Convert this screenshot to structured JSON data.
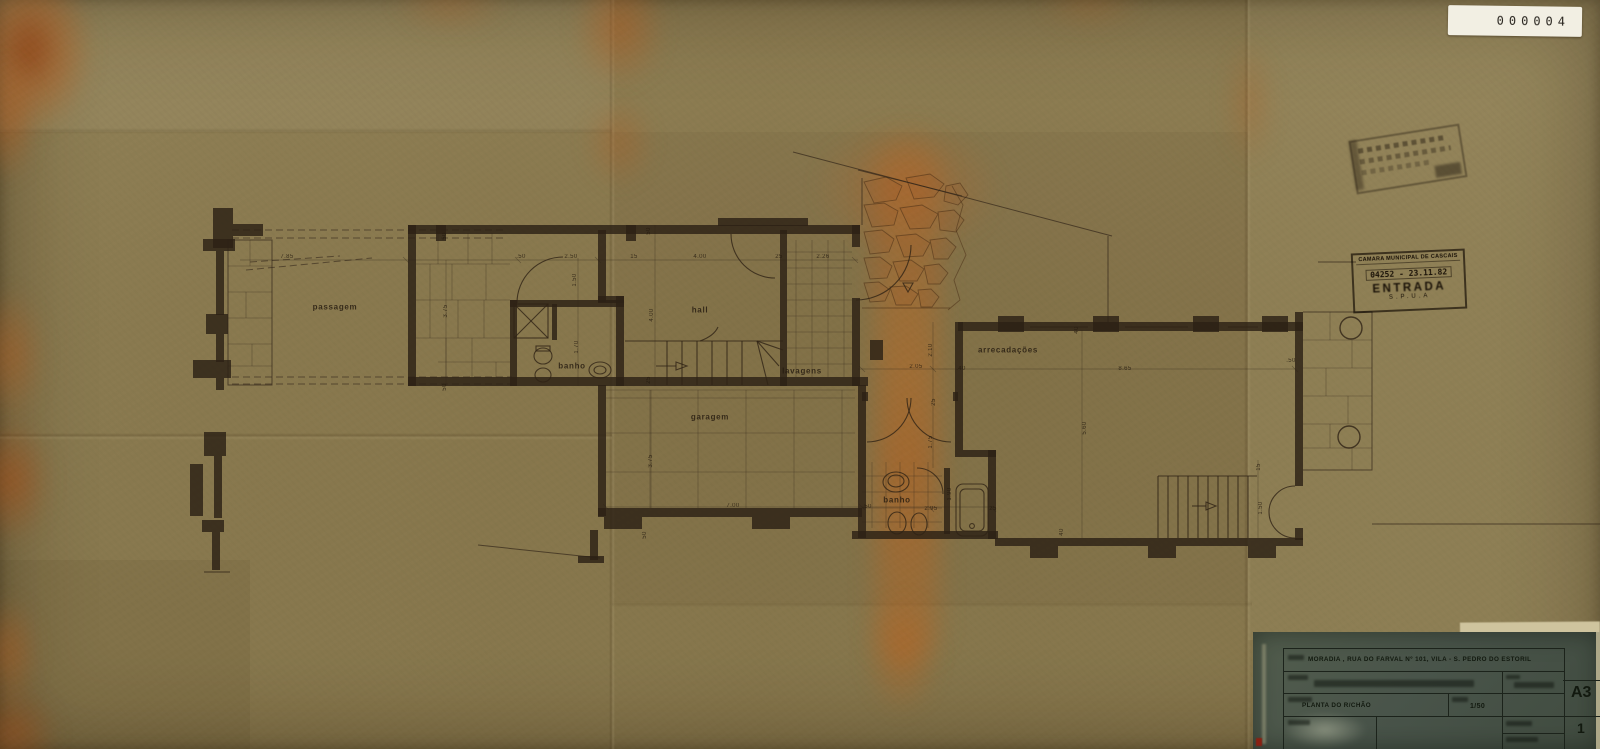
{
  "tag": {
    "number": "000004"
  },
  "entry_stamp": {
    "org_line": "CÂMARA MUNICIPAL DE CASCAIS",
    "number_date": "04252 - 23.11.82",
    "word": "ENTRADA",
    "dept": "S.P.U.A"
  },
  "plan": {
    "rooms": [
      {
        "label": "passagem",
        "x": 335,
        "y": 307
      },
      {
        "label": "banho",
        "x": 572,
        "y": 366
      },
      {
        "label": "hall",
        "x": 700,
        "y": 310
      },
      {
        "label": "lavagens",
        "x": 802,
        "y": 371
      },
      {
        "label": "garagem",
        "x": 710,
        "y": 417
      },
      {
        "label": "arrecadações",
        "x": 1008,
        "y": 350
      },
      {
        "label": "banho",
        "x": 897,
        "y": 500
      }
    ],
    "dimensions": [
      {
        "t": "7.85",
        "x": 287,
        "y": 257,
        "r": 0
      },
      {
        "t": ".50",
        "x": 521,
        "y": 257,
        "r": 0
      },
      {
        "t": "2.50",
        "x": 571,
        "y": 257,
        "r": 0
      },
      {
        "t": "15",
        "x": 634,
        "y": 257,
        "r": 0
      },
      {
        "t": "4.00",
        "x": 700,
        "y": 257,
        "r": 0
      },
      {
        "t": "25",
        "x": 779,
        "y": 257,
        "r": 0
      },
      {
        "t": "2.26",
        "x": 823,
        "y": 257,
        "r": 0
      },
      {
        "t": "50",
        "x": 445,
        "y": 236,
        "r": 90
      },
      {
        "t": "50",
        "x": 649,
        "y": 231,
        "r": 90
      },
      {
        "t": "50",
        "x": 445,
        "y": 387,
        "r": 90
      },
      {
        "t": "1.50",
        "x": 575,
        "y": 280,
        "r": 90
      },
      {
        "t": "1.70",
        "x": 577,
        "y": 347,
        "r": 90
      },
      {
        "t": "4.00",
        "x": 652,
        "y": 315,
        "r": 90
      },
      {
        "t": "25",
        "x": 649,
        "y": 380,
        "r": 90
      },
      {
        "t": "3.75",
        "x": 446,
        "y": 311,
        "r": 90
      },
      {
        "t": "2.05",
        "x": 916,
        "y": 367,
        "r": 0
      },
      {
        "t": "2.10",
        "x": 931,
        "y": 350,
        "r": 90
      },
      {
        "t": ".40",
        "x": 961,
        "y": 369,
        "r": 0
      },
      {
        "t": "25",
        "x": 934,
        "y": 402,
        "r": 90
      },
      {
        "t": "1.75",
        "x": 931,
        "y": 442,
        "r": 90
      },
      {
        "t": "40",
        "x": 1077,
        "y": 330,
        "r": 90
      },
      {
        "t": "8.65",
        "x": 1125,
        "y": 369,
        "r": 0
      },
      {
        "t": "5.60",
        "x": 1085,
        "y": 428,
        "r": 90
      },
      {
        "t": ".50",
        "x": 1291,
        "y": 361,
        "r": 0
      },
      {
        "t": "15",
        "x": 1259,
        "y": 467,
        "r": 90
      },
      {
        "t": "1.50",
        "x": 1261,
        "y": 508,
        "r": 90
      },
      {
        "t": "3.75",
        "x": 651,
        "y": 461,
        "r": 90
      },
      {
        "t": "7.00",
        "x": 733,
        "y": 506,
        "r": 0
      },
      {
        "t": ".50",
        "x": 867,
        "y": 507,
        "r": 0
      },
      {
        "t": "2.95",
        "x": 931,
        "y": 509,
        "r": 0
      },
      {
        "t": "25",
        "x": 993,
        "y": 509,
        "r": 0
      },
      {
        "t": "1.90",
        "x": 950,
        "y": 494,
        "r": 90
      },
      {
        "t": "50",
        "x": 645,
        "y": 535,
        "r": 90
      },
      {
        "t": "40",
        "x": 1062,
        "y": 532,
        "r": 90
      }
    ]
  },
  "title_block": {
    "address_line": "MORADIA , RUA DO FARVAL Nº 101, VILA - S. PEDRO DO ESTORIL",
    "drawing_title": "PLANTA DO R/CHÃO",
    "scale": "1/50",
    "sheet_size": "A3",
    "sheet_number": "1"
  },
  "colors": {
    "paper": "#8b7b51",
    "stain_orange": "#b15a1d",
    "ink": "#2c2115",
    "title_panel": "#4c574a",
    "label_white": "#f2efe3"
  }
}
